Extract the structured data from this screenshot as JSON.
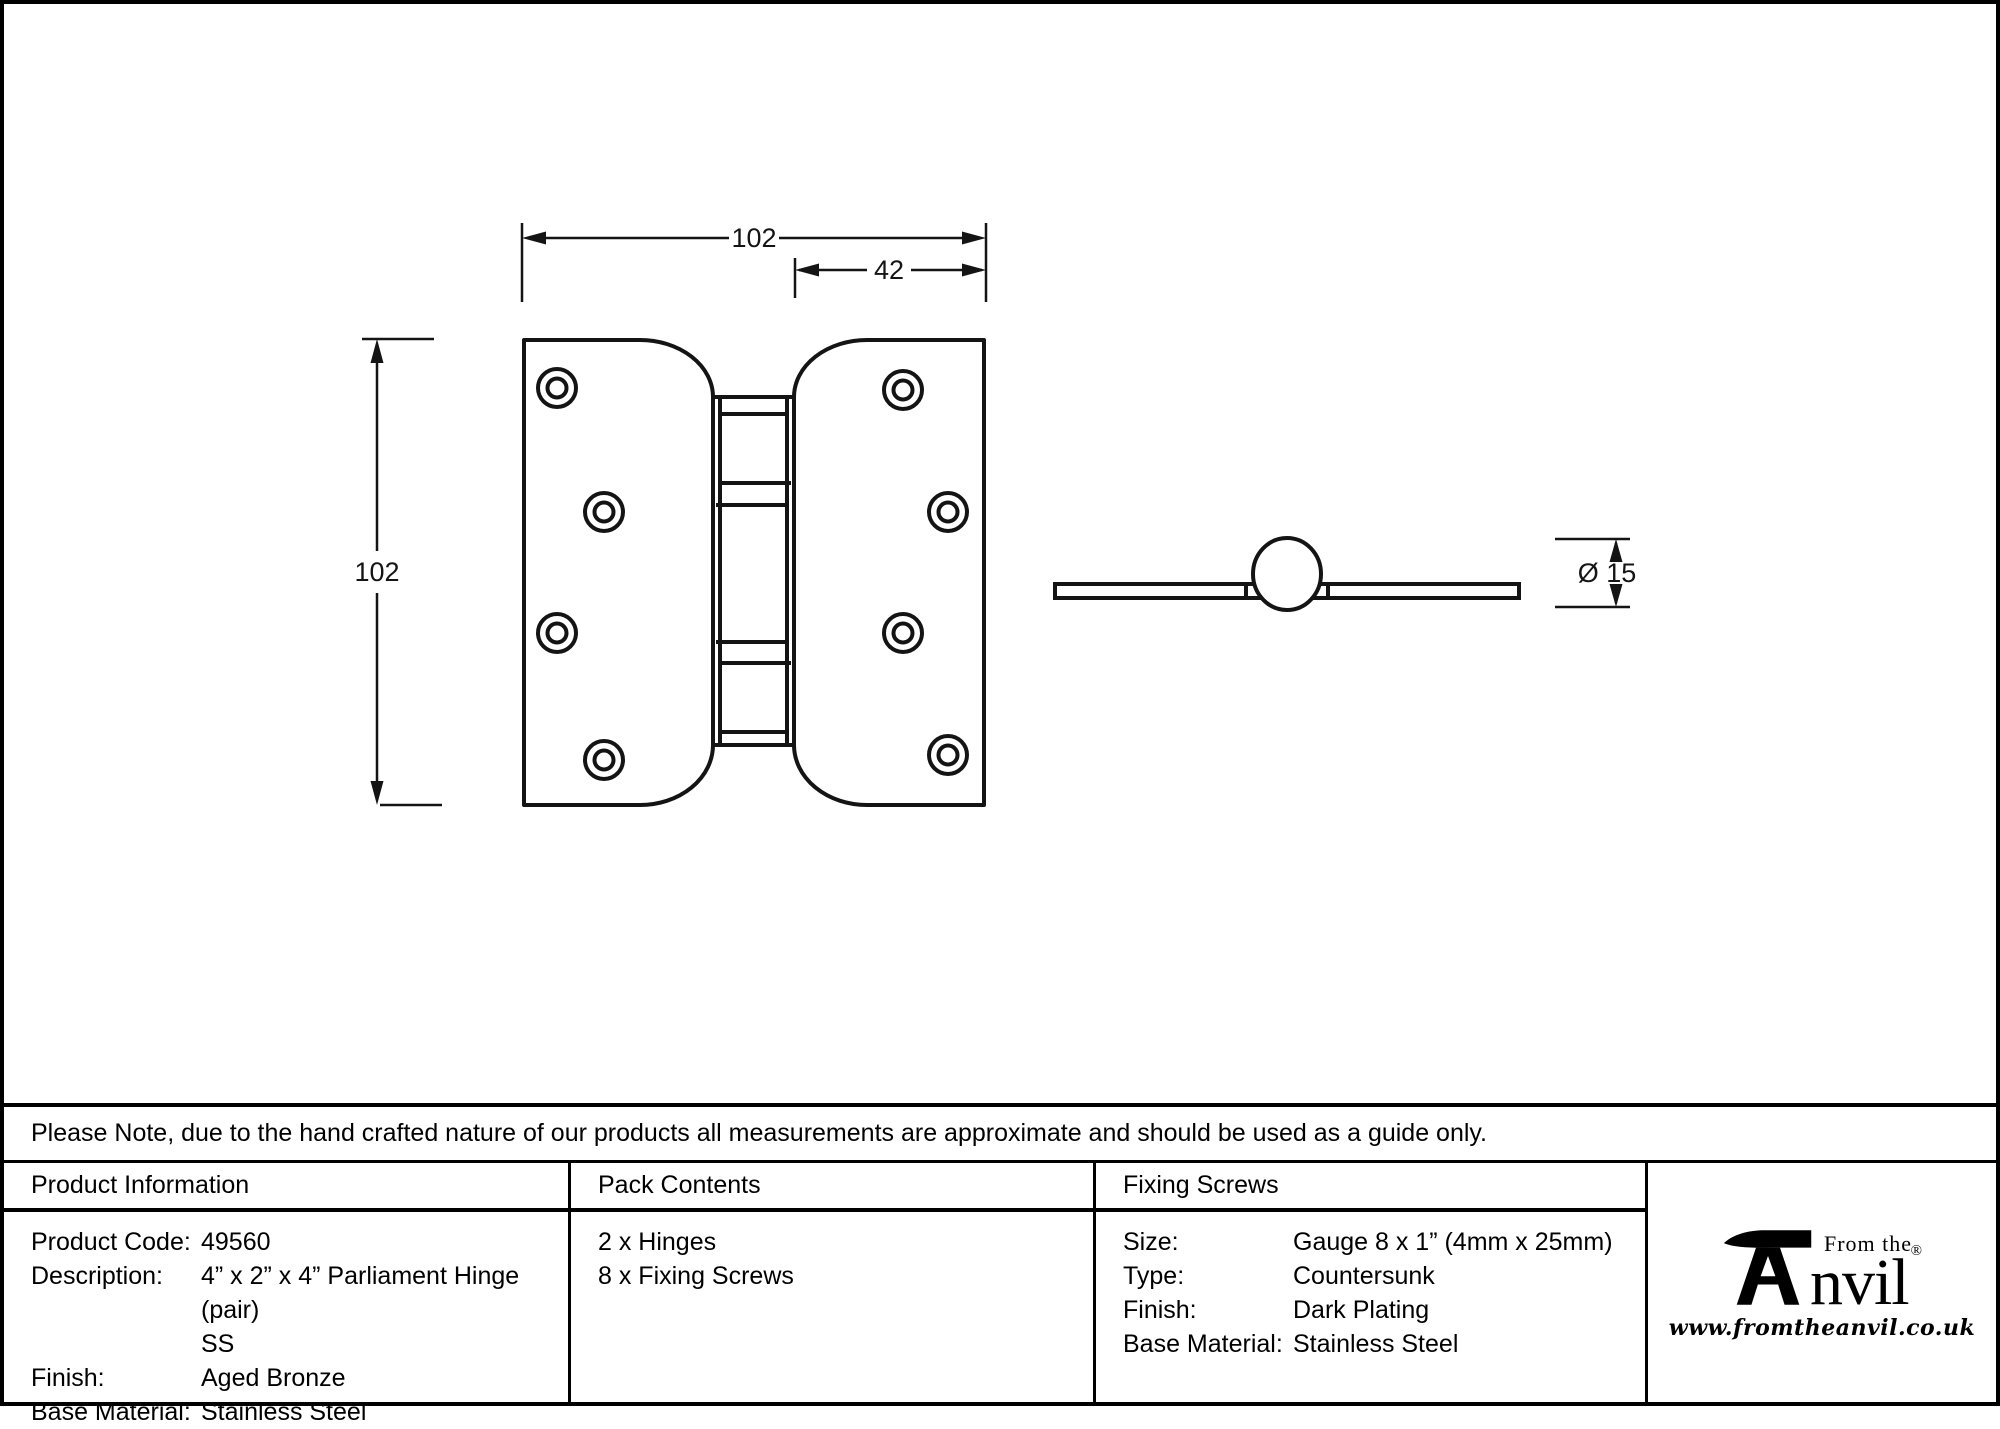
{
  "drawing": {
    "front_view": {
      "width_label": "102",
      "inset_label": "42",
      "height_label": "102"
    },
    "side_view": {
      "diameter_label": "Ø 15"
    }
  },
  "note": "Please Note, due to the hand crafted nature of our products all measurements are approximate and should be used as a guide only.",
  "tables": {
    "product_information": {
      "title": "Product Information",
      "rows": [
        {
          "label": "Product Code:",
          "value": "49560"
        },
        {
          "label": "Description:",
          "value": "4” x 2” x 4” Parliament Hinge (pair)\nSS"
        },
        {
          "label": "Finish:",
          "value": "Aged Bronze"
        },
        {
          "label": "Base Material:",
          "value": "Stainless Steel"
        }
      ]
    },
    "pack_contents": {
      "title": "Pack Contents",
      "items": [
        "2 x Hinges",
        "8 x Fixing Screws"
      ]
    },
    "fixing_screws": {
      "title": "Fixing Screws",
      "rows": [
        {
          "label": "Size:",
          "value": "Gauge 8 x 1” (4mm x 25mm)"
        },
        {
          "label": "Type:",
          "value": "Countersunk"
        },
        {
          "label": "Finish:",
          "value": "Dark Plating"
        },
        {
          "label": "Base Material:",
          "value": "Stainless Steel"
        }
      ]
    }
  },
  "logo": {
    "tagline": "From the",
    "brand_suffix": "nvil",
    "registered": "®",
    "website": "www.fromtheanvil.co.uk"
  },
  "colors": {
    "line": "#141414",
    "background": "#ffffff"
  }
}
